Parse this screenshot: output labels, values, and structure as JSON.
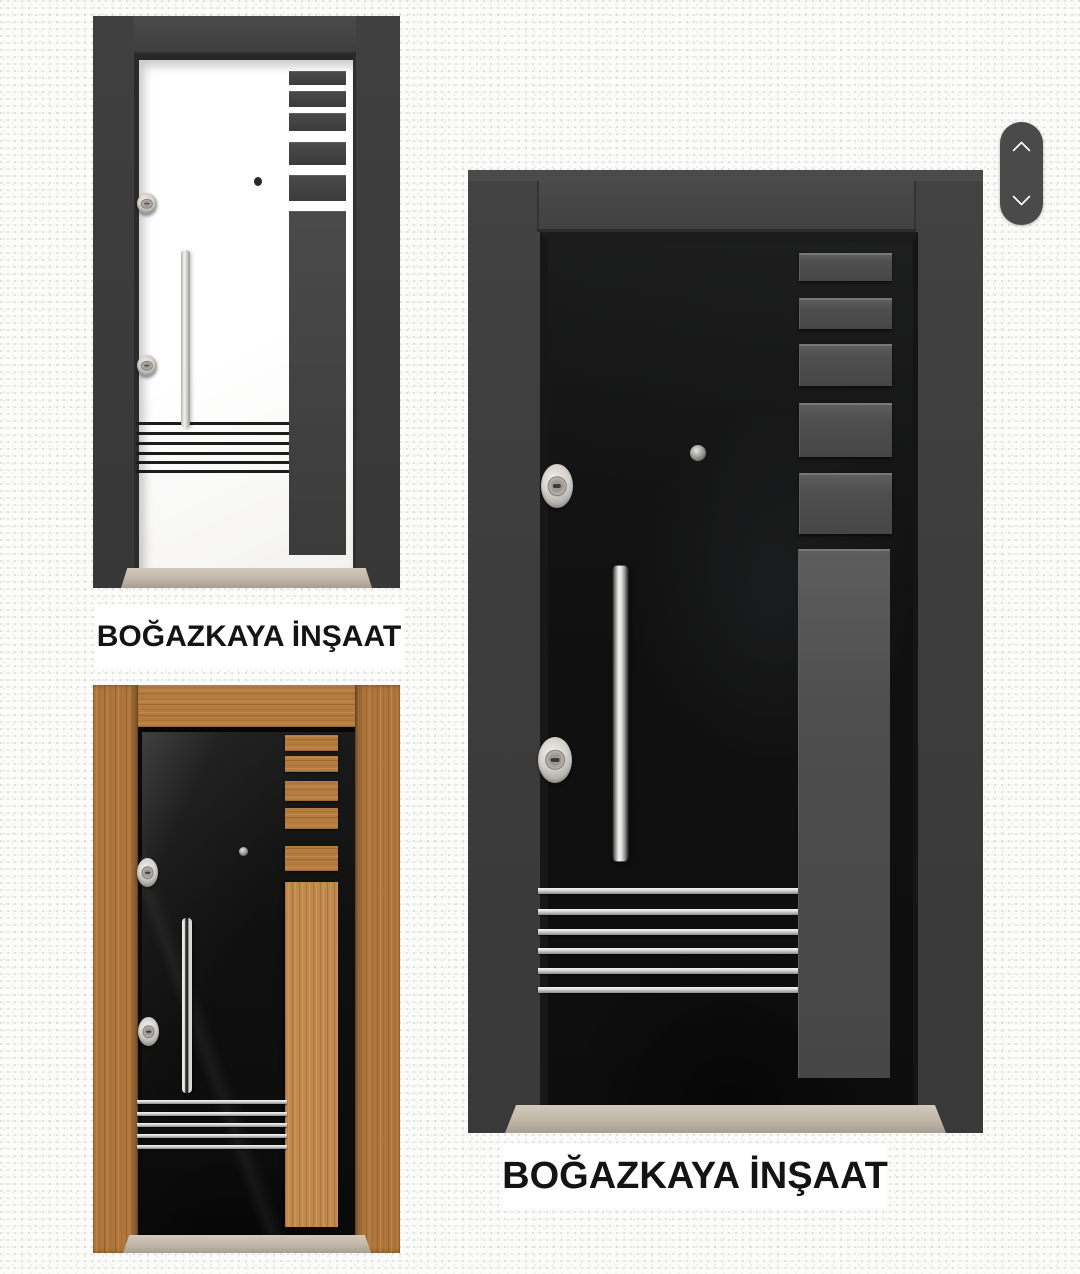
{
  "captions": {
    "white_door": "BOĞAZKAYA İNŞAAT",
    "black_door": "BOĞAZKAYA İNŞAAT"
  },
  "scroll_control": {
    "up_icon": "chevron-up",
    "down_icon": "chevron-down",
    "background_color": "#4a4a4a",
    "icon_color": "#ffffff"
  },
  "products": [
    {
      "id": "white-steel-door",
      "caption": "BOĞAZKAYA İNŞAAT",
      "frame_color": "#3b3b3b",
      "leaf_color": "#ffffff",
      "accent_color": "#3f3f3f",
      "sill_color": "#c3baac",
      "visible_features": "right accent column with five slats, chrome vertical handle, two locks, peephole, six thin black stripes near bottom"
    },
    {
      "id": "black-steel-door",
      "caption": "BOĞAZKAYA İNŞAAT",
      "frame_color": "#3d3d3d",
      "leaf_color": "#0f0f0f",
      "accent_color": "#4e4e4e",
      "sill_color": "#c0b7aa",
      "visible_features": "grey accent column with five stacked panels, chrome vertical handle, two chrome locks, peephole, six chrome stripes near bottom"
    },
    {
      "id": "wooden-laminate-door",
      "frame_color": "#b0773c",
      "leaf_color": "#121212",
      "accent_color": "#c0894d",
      "sill_color": "#c3baac",
      "visible_features": "wood frame, glossy black leaf, wooden accent column with five slats, chrome vertical handle, two chrome locks, peephole, five chrome stripes near bottom"
    }
  ]
}
